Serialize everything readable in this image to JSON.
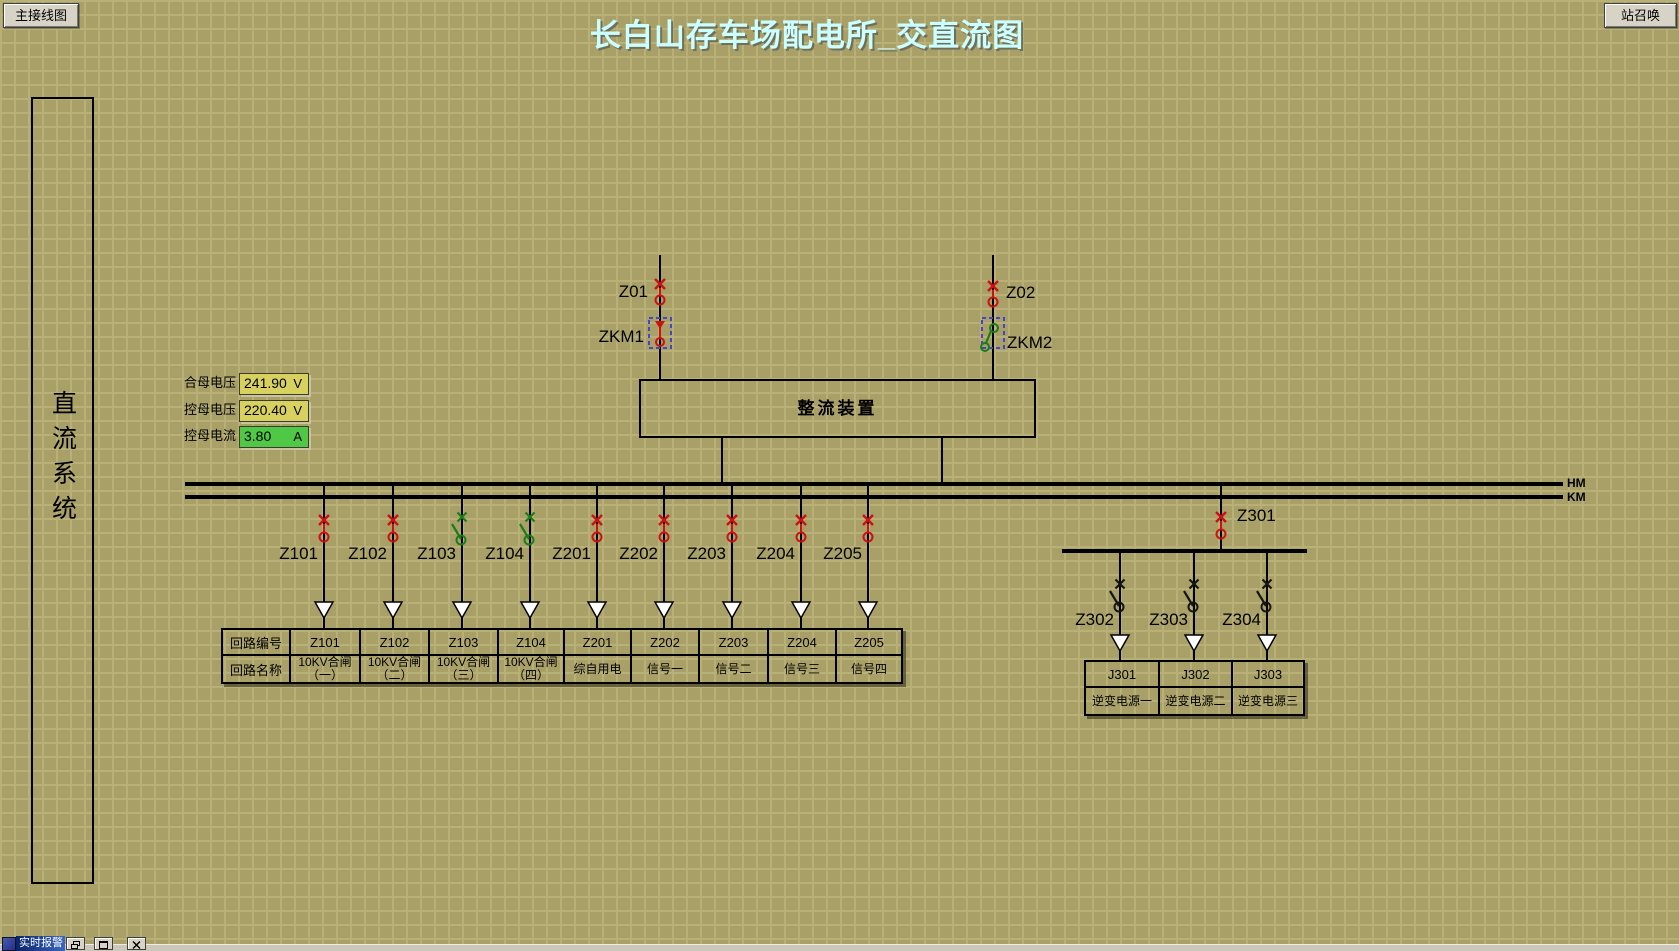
{
  "header": {
    "title": "长白山存车场配电所_交直流图",
    "left_button": "主接线图",
    "right_button": "站召唤"
  },
  "sidebar": {
    "label": "直流系统"
  },
  "measurements": [
    {
      "label": "合母电压",
      "value": "241.90",
      "unit": "V",
      "field_color": "#d8d160"
    },
    {
      "label": "控母电压",
      "value": "220.40",
      "unit": "V",
      "field_color": "#d8d160"
    },
    {
      "label": "控母电流",
      "value": "3.80",
      "unit": "A",
      "field_color": "#4fc846"
    }
  ],
  "diagram": {
    "rectifier_label": "整流装置",
    "bus_labels": {
      "hm": "HM",
      "km": "KM"
    },
    "sources": [
      {
        "id": "Z01",
        "breaker": "ZKM1",
        "breaker_state": "closed"
      },
      {
        "id": "Z02",
        "breaker": "ZKM2",
        "breaker_state": "open"
      }
    ],
    "feeders": [
      {
        "id": "Z101",
        "state": "closed"
      },
      {
        "id": "Z102",
        "state": "closed"
      },
      {
        "id": "Z103",
        "state": "open"
      },
      {
        "id": "Z104",
        "state": "open"
      },
      {
        "id": "Z201",
        "state": "closed"
      },
      {
        "id": "Z202",
        "state": "closed"
      },
      {
        "id": "Z203",
        "state": "closed"
      },
      {
        "id": "Z204",
        "state": "closed"
      },
      {
        "id": "Z205",
        "state": "closed"
      }
    ],
    "branch": {
      "id": "Z301",
      "state": "closed",
      "sub_feeders": [
        {
          "id": "Z302",
          "state": "open"
        },
        {
          "id": "Z303",
          "state": "open"
        },
        {
          "id": "Z304",
          "state": "open"
        }
      ]
    }
  },
  "left_table": {
    "row_headers": [
      "回路编号",
      "回路名称"
    ],
    "columns": [
      {
        "code": "Z101",
        "name": "10KV合闸（一）"
      },
      {
        "code": "Z102",
        "name": "10KV合闸（二）"
      },
      {
        "code": "Z103",
        "name": "10KV合闸（三）"
      },
      {
        "code": "Z104",
        "name": "10KV合闸（四）"
      },
      {
        "code": "Z201",
        "name": "综自用电"
      },
      {
        "code": "Z202",
        "name": "信号一"
      },
      {
        "code": "Z203",
        "name": "信号二"
      },
      {
        "code": "Z204",
        "name": "信号三"
      },
      {
        "code": "Z205",
        "name": "信号四"
      }
    ]
  },
  "right_table": {
    "columns": [
      {
        "code": "J301",
        "name": "逆变电源一"
      },
      {
        "code": "J302",
        "name": "逆变电源二"
      },
      {
        "code": "J303",
        "name": "逆变电源三"
      }
    ]
  },
  "taskbar": {
    "alarm_panel_title": "实时报警"
  },
  "colors": {
    "background": "#a9a068",
    "grid_line": "#b9b078",
    "title_text": "#ccffff",
    "closed_breaker": "#cc1111",
    "open_breaker": "#1a7d1a",
    "branch_switch": "#141414",
    "contactor_box": "#4444cc",
    "voltage_field_bg": "#d8d160",
    "current_field_bg": "#4fc846",
    "bus": "#000000"
  }
}
